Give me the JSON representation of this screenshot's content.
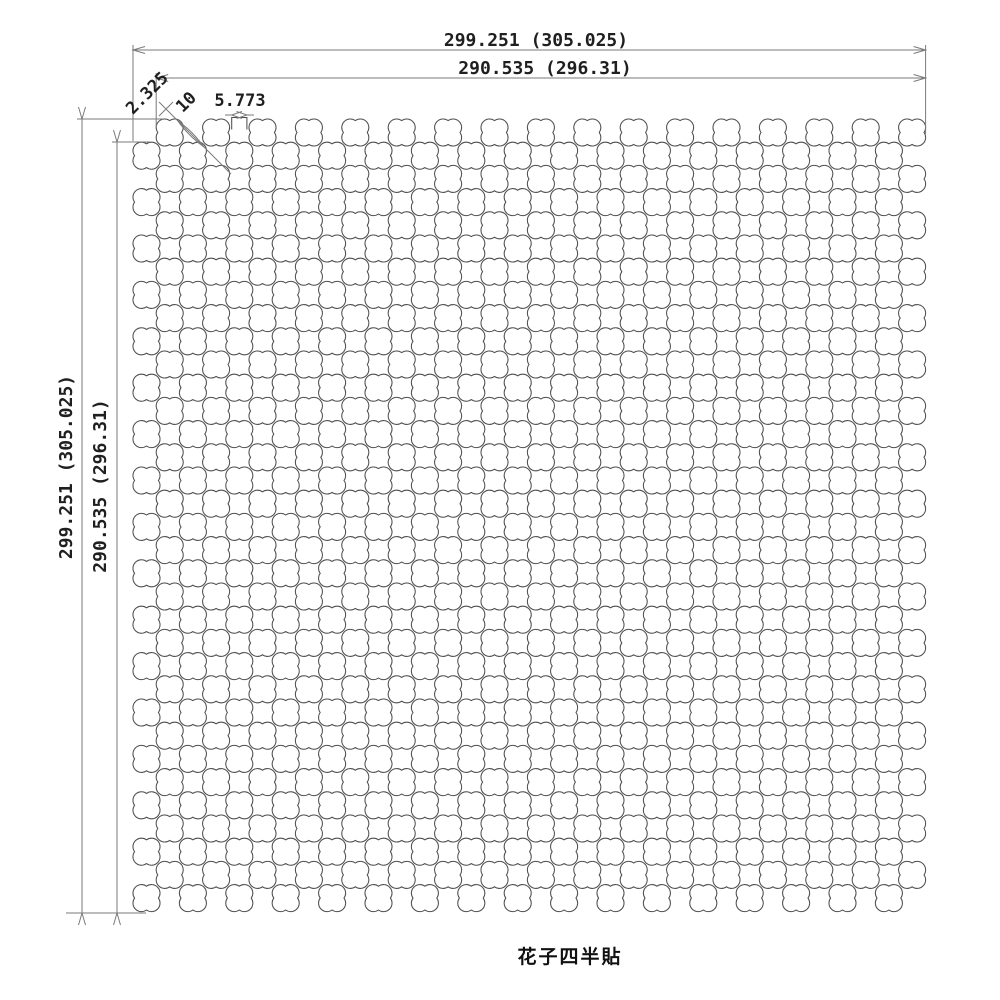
{
  "title": {
    "text": "花子四半貼"
  },
  "dimensions": {
    "top_outer": {
      "label": "299.251 (305.025)"
    },
    "top_inner": {
      "label": "290.535 (296.31)"
    },
    "left_outer": {
      "label": "299.251 (305.025)"
    },
    "left_inner": {
      "label": "290.535 (296.31)"
    },
    "diagonal_gap": {
      "label": "2.325"
    },
    "hole_pitch": {
      "label": "10"
    },
    "edge_neck": {
      "label": "5.773"
    }
  },
  "pattern": {
    "shape": "quatrefoil",
    "rows": 34,
    "grid_lines": 34,
    "holes_per_row": 17,
    "total_holes": 578,
    "half_pitch_px": 23.2,
    "origin_x": 146.5,
    "origin_y": 132.5,
    "cusp_radius": 11.9,
    "lobe_radius": 8.52,
    "stroke_color": "#4f4f4f"
  },
  "canvas": {
    "background": "#ffffff",
    "line_color": "#7a7a7a",
    "text_color": "#1f1f1f"
  }
}
